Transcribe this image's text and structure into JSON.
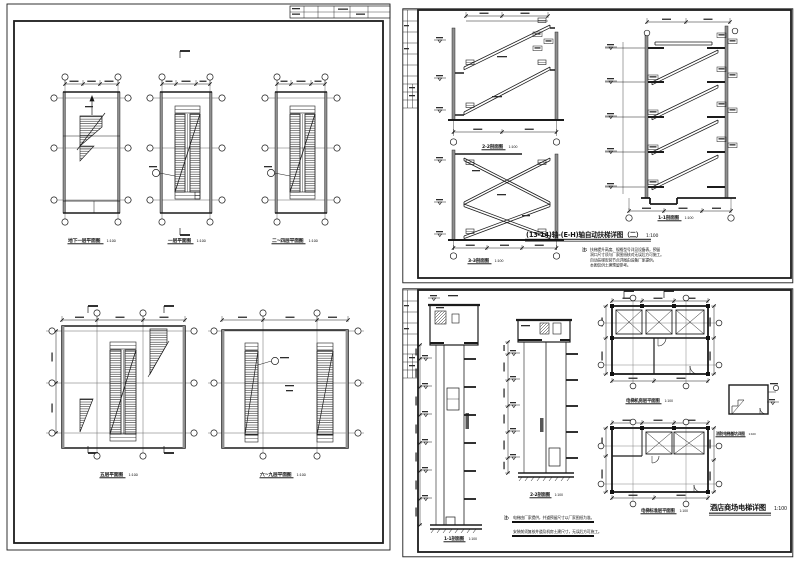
{
  "page": {
    "background": "#ffffff",
    "line_color": "#1b1b1b"
  },
  "sheet_left": {
    "description": "自动扶梯各层平面图",
    "plans": [
      {
        "caption": "地下一层平面图",
        "scale": "1:100"
      },
      {
        "caption": "一层平面图",
        "scale": "1:100"
      },
      {
        "caption": "二~四层平面图",
        "scale": "1:100"
      },
      {
        "caption": "五层平面图",
        "scale": "1:100"
      },
      {
        "caption": "六~九层平面图",
        "scale": "1:100"
      }
    ]
  },
  "sheet_top_right": {
    "sections": [
      {
        "caption": "2-2剖面图",
        "scale": "1:100"
      },
      {
        "caption": "3-3剖面图",
        "scale": "1:100"
      },
      {
        "caption": "1-1剖面图",
        "scale": "1:100"
      }
    ],
    "title": "(13-14)轴-(E-H)轴自动扶梯详图（二）",
    "title_scale": "1:100",
    "notes_label": "注:",
    "notes": [
      "扶梯提升高度、规格型号详见设备表，预留",
      "洞口尺寸须与厂家图纸核对无误后方可施工。",
      "自动扶梯安装节点详图由设备厂家提供，",
      "本图仅供土建预留参考。"
    ]
  },
  "sheet_bottom_right": {
    "sections": [
      {
        "caption": "1-1剖面图",
        "scale": "1:100"
      },
      {
        "caption": "2-2剖面图",
        "scale": "1:100"
      }
    ],
    "plans": [
      {
        "caption": "电梯机房层平面图",
        "scale": "1:100"
      },
      {
        "caption": "电梯标准层平面图",
        "scale": "1:100"
      },
      {
        "caption": "消防电梯基坑详图",
        "scale": "1:100"
      }
    ],
    "title": "酒店商场电梯详图",
    "title_scale": "1:100",
    "notes_label": "注:",
    "notes": [
      "电梯由厂家提供，井道预留尺寸以厂家图纸为准。",
      "安装前须复核井道及机房土建尺寸，无误后方可施工。"
    ]
  }
}
